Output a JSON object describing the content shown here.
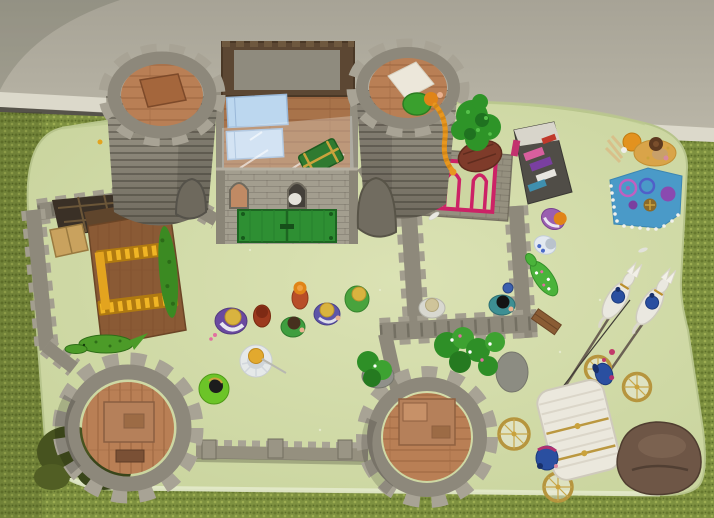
{
  "scene": {
    "type": "photograph",
    "subject": "Playmobil medieval castle playset seen from above",
    "surface": "pale green foam play mat laid on olive-green carpet",
    "background": "beige room wall with white baseboard at top of frame"
  },
  "colors": {
    "room_wall": "#aba797",
    "baseboard": "#dcd9cb",
    "carpet": "#7e9140",
    "mat": "#ccd7a2",
    "stone": "#8e897b",
    "stone_light": "#a39e8f",
    "stone_dark": "#6f6a5e",
    "tower_floor": "#b97f55",
    "keep_floor": "#a8734a",
    "door_green": "#2e8f33",
    "stable_wood": "#8a5a35",
    "ladder_yellow": "#e3a41f",
    "window_pink": "#cc2266",
    "bed_blue": "#bcd7ef",
    "blanket_blue": "#4a9ac8",
    "picnic_rug": "#d9a449",
    "carriage_white": "#ebe8dd",
    "wheel_gold": "#b6953e",
    "rider_blue": "#2a4fa0",
    "foliage": "#2e9428",
    "moss": "#47531f",
    "rock_brown": "#6e5646",
    "croc_green": "#4c9b28"
  },
  "objects": {
    "towers": [
      {
        "name": "tower-northwest",
        "desc": "round grey tower with crenellations, wooden floor and trapdoor, arched side opening"
      },
      {
        "name": "tower-northeast",
        "desc": "round grey tower with figure in green, long orange braid hanging over wall, white blanket on floor"
      },
      {
        "name": "tower-southwest",
        "desc": "round grey tower seen from directly above, plank floor with furniture, moss at its base"
      },
      {
        "name": "tower-south-center",
        "desc": "round grey tower seen from above with plank floor and bed frame"
      }
    ],
    "keep": {
      "name": "castle-keep",
      "desc": "square stone keep, open top with brown floor, two blue beds under plastic wrap, green treasure chest, two arched windows, green double gate"
    },
    "stable_courtyard": {
      "name": "west-courtyard-stable",
      "desc": "walled courtyard with wooden stable, two yellow hay-rack ladders, tan trapdoor, green hedge, green crocodile outside"
    },
    "east_courtyard": {
      "name": "east-courtyard",
      "desc": "walled yard with pink arched window wall, market stall with coloured cloth goods, drawbridge plank, two figures and a flowered crocodile"
    },
    "market_stall": {
      "name": "market-stall",
      "desc": "dark awning stall with pink, purple, white, teal and red goods and a brown table"
    },
    "figures": [
      {
        "name": "villager-red",
        "body_color": "#b84e28",
        "hair_color": "#e08418",
        "location": "courtyard center"
      },
      {
        "name": "noblewoman-purple",
        "body_color": "#6a4aa0",
        "hair_color": "#d9b33f",
        "location": "courtyard"
      },
      {
        "name": "monk-russet",
        "body_color": "#9c3a1e",
        "hair_color": "#7e2a14",
        "location": "courtyard"
      },
      {
        "name": "villager-green",
        "body_color": "#3f9e3f",
        "hair_color": "#46301e",
        "location": "courtyard"
      },
      {
        "name": "noblewoman-blue",
        "body_color": "#5e55a8",
        "hair_color": "#d9b33f",
        "location": "courtyard"
      },
      {
        "name": "villager-lime",
        "body_color": "#49a33d",
        "hair_color": "#d9b33f",
        "location": "courtyard"
      },
      {
        "name": "queen-white-gown",
        "body_color": "#e7eaed",
        "hair_color": "#e2a92e",
        "location": "courtyard, holding staff"
      },
      {
        "name": "friar-green",
        "body_color": "#6cc428",
        "hair_color": "#1c1c1c",
        "location": "courtyard south"
      },
      {
        "name": "figure-grey",
        "body_color": "#d8d8d0",
        "hair_color": "#cfc49a",
        "location": "east courtyard"
      },
      {
        "name": "figure-teal",
        "body_color": "#3d8f93",
        "hair_color": "#141414",
        "location": "east courtyard"
      },
      {
        "name": "figure-violet",
        "body_color": "#9a5fb0",
        "hair_color": "#e08418",
        "location": "beside market stall"
      },
      {
        "name": "figure-white-blue",
        "body_color": "#e3e9f0",
        "hair_color": "#b9c2cc",
        "location": "beside market stall"
      },
      {
        "name": "figure-orange-picnic",
        "body_color": "#e2921f",
        "hair_color": "#e08418",
        "location": "picnic corner northeast"
      },
      {
        "name": "figure-brown-bun",
        "body_color": "#c8a06a",
        "hair_color": "#5e3a20",
        "location": "tan picnic rug"
      },
      {
        "name": "tower-maiden",
        "body_color": "#3aa02e",
        "hair_color": "#e8971f",
        "location": "northeast tower top, braid over parapet"
      }
    ],
    "carriage": {
      "name": "royal-carriage",
      "desc": "white coach with gold-rimmed wheels drawn by two white horses with plumed blue riders, blue driver and rear footman"
    },
    "picnic": {
      "name": "picnic-corner",
      "desc": "blue blanket edged with white beads holding purple and blue rings, wheel and trinkets; tan rug with hay wisps"
    },
    "nature": [
      {
        "name": "tree-green",
        "location": "right of northeast tower"
      },
      {
        "name": "flower-bushes",
        "location": "south of east courtyard with grey rocks"
      },
      {
        "name": "moss-patch",
        "location": "base of southwest tower"
      },
      {
        "name": "brown-rock",
        "location": "bottom right corner"
      },
      {
        "name": "crocodile-west",
        "location": "outside stable"
      },
      {
        "name": "crocodile-flowered",
        "location": "east wall"
      }
    ]
  }
}
